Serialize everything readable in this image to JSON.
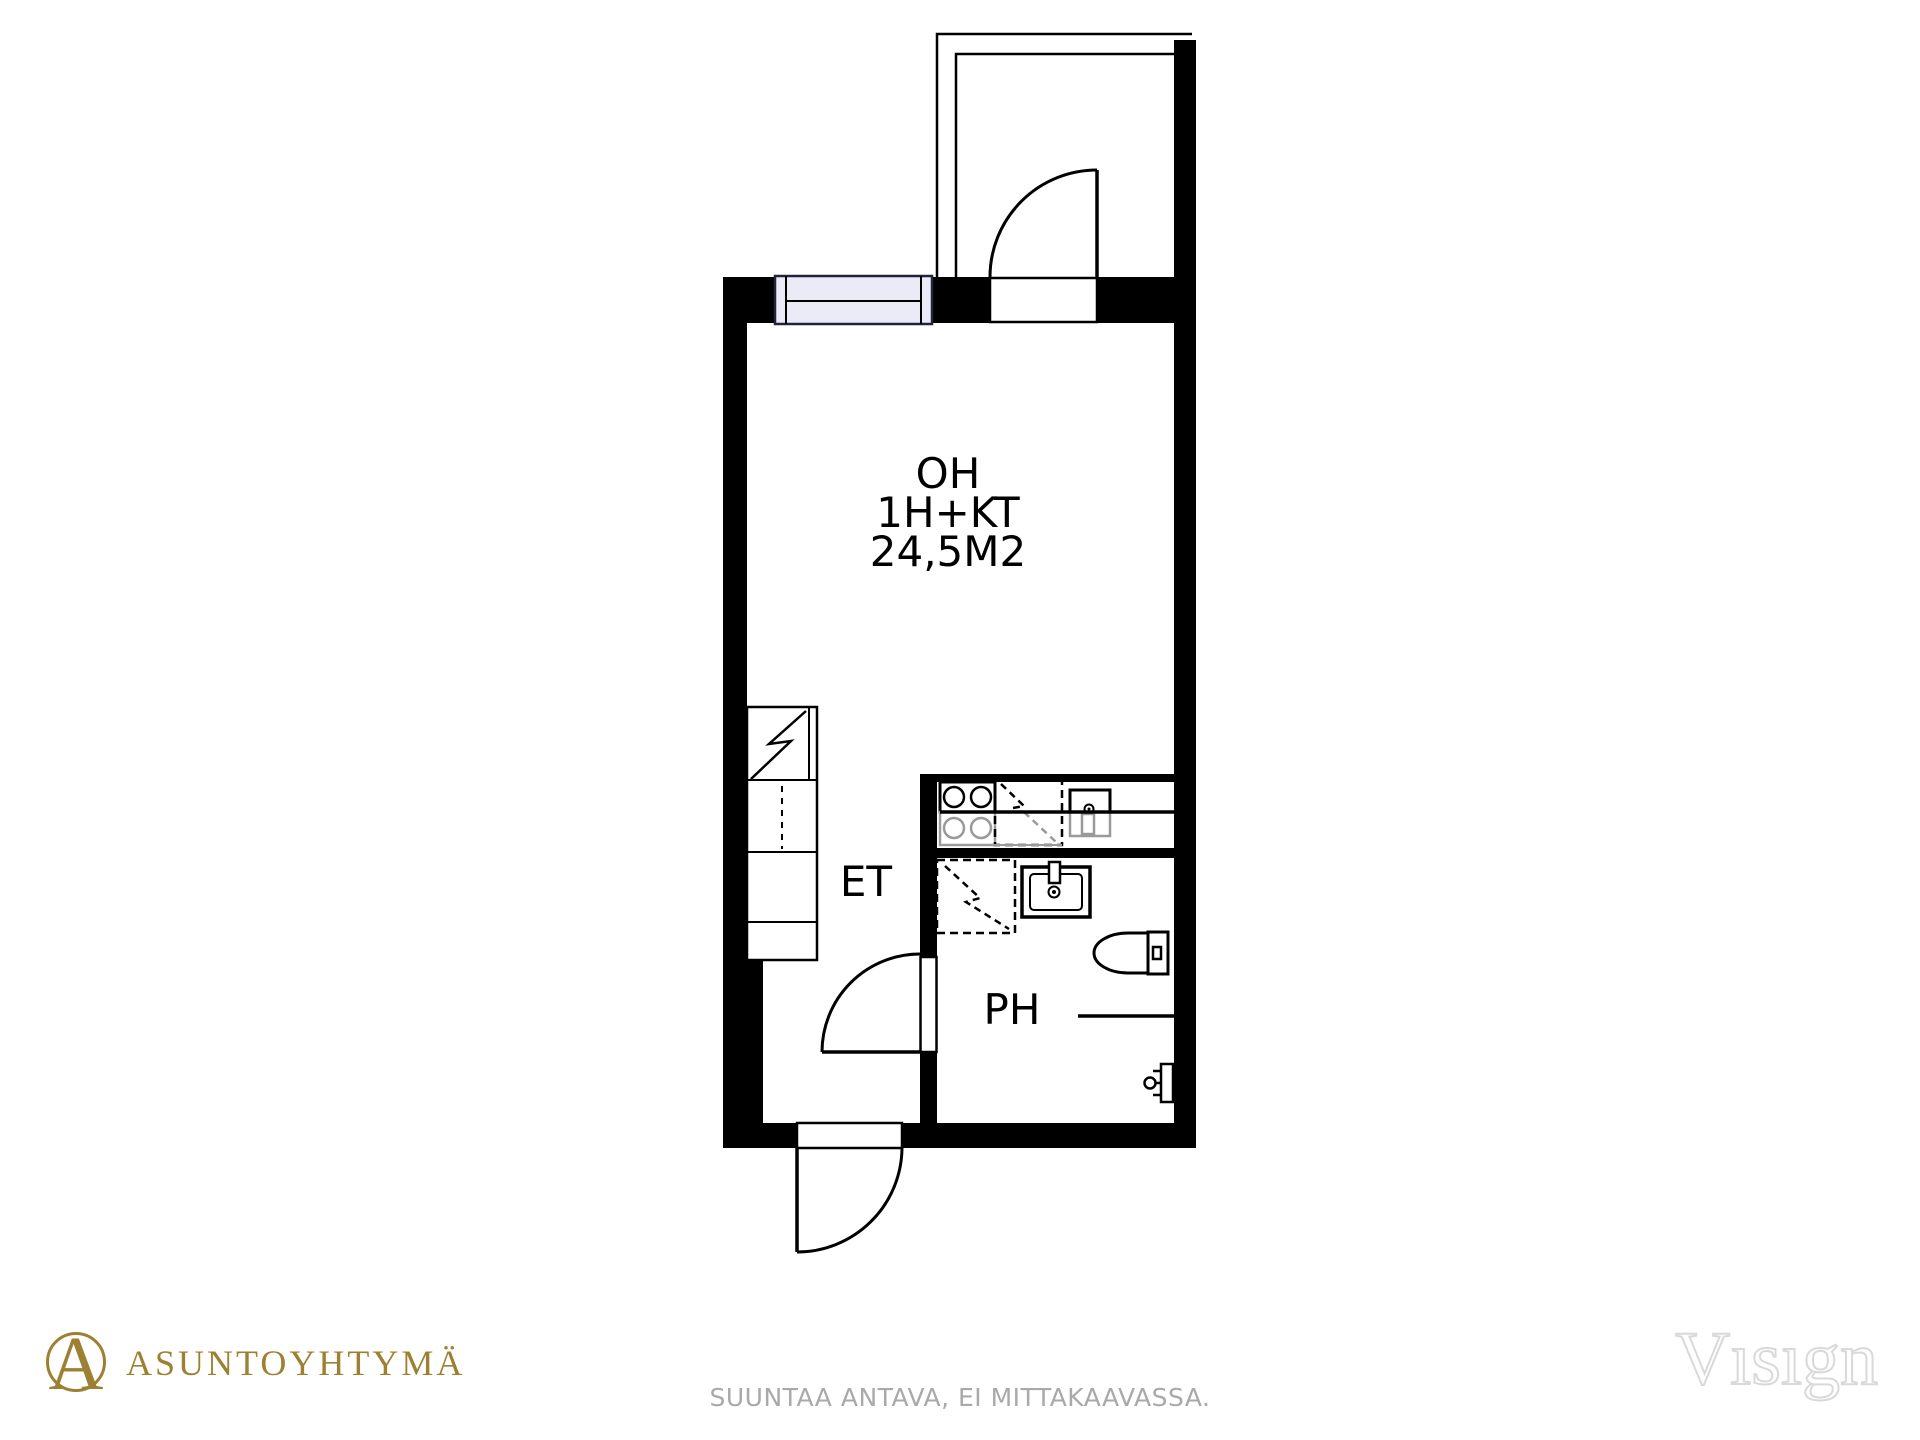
{
  "plan": {
    "rooms": {
      "living": {
        "name": "OH",
        "type": "1H+KT",
        "area": "24,5M2"
      },
      "entry": {
        "name": "ET"
      },
      "bathroom": {
        "name": "PH"
      }
    }
  },
  "footer": {
    "brand_mark": "A",
    "brand_name": "ASUNTOYHTYMÄ",
    "disclaimer": "SUUNTAA ANTAVA, EI MITTAKAAVASSA.",
    "watermark": "Vısıgn"
  },
  "colors": {
    "wall": "#000000",
    "window_fill": "#ebebf8",
    "appliance_gray": "#9a9a9a",
    "brand_gold": "#9d8031",
    "disclaimer_gray": "#a9a9a9",
    "watermark_outline": "#d9d9d9"
  }
}
